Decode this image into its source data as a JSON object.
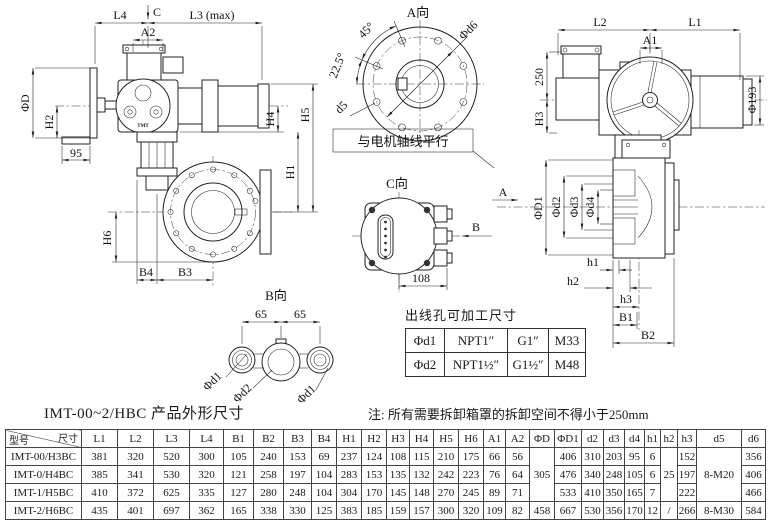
{
  "colors": {
    "ink": "#222222",
    "background": "#ffffff"
  },
  "views": {
    "side_view": {
      "labels": {
        "l4": "L4",
        "c": "C",
        "l3": "L3 (max)",
        "a2": "A2",
        "phi_d": "ΦD",
        "h2": "H2",
        "dim95": "95",
        "h4": "H4",
        "h1": "H1",
        "h5": "H5",
        "h6": "H6",
        "b4": "B4",
        "b3": "B3"
      },
      "logo": "TMT"
    },
    "a_view": {
      "title": "A向",
      "labels": {
        "angle45": "45°",
        "angle225": "22.5°",
        "phi_d6": "Φd6",
        "d5": "d5"
      },
      "note": "与电机轴线平行"
    },
    "front_view": {
      "labels": {
        "l2": "L2",
        "l1": "L1",
        "a1": "A1",
        "dim250": "250",
        "h3": "H3",
        "phi193": "Φ193"
      }
    },
    "section_view": {
      "labels": {
        "a_arrow": "A",
        "phi_d1": "ΦD1",
        "phi_d2": "Φd2",
        "phi_d3": "Φd3",
        "phi_d4": "Φd4",
        "h1": "h1",
        "h2": "h2",
        "h3": "h3",
        "b1": "B1",
        "b2": "B2"
      }
    },
    "c_view": {
      "title": "C向",
      "labels": {
        "b_arrow": "B",
        "dim108": "108"
      }
    },
    "b_view": {
      "title": "B向",
      "labels": {
        "dim65_left": "65",
        "dim65_right": "65",
        "phi_d1_left": "Φd1",
        "phi_d2": "Φd2",
        "phi_d1_right": "Φd1"
      }
    }
  },
  "thread_table": {
    "title": "出线孔可加工尺寸",
    "rows": [
      [
        "Φd1",
        "NPT1″",
        "G1″",
        "M33"
      ],
      [
        "Φd2",
        "NPT1½″",
        "G1½″",
        "M48"
      ]
    ]
  },
  "caption": {
    "title": "IMT-00~2/HBC 产品外形尺寸",
    "note": "注: 所有需要拆卸箱罩的拆卸空间不得小于250mm"
  },
  "dimension_table": {
    "corner": {
      "top_right": "尺寸",
      "bottom_left": "型号"
    },
    "columns": [
      "L1",
      "L2",
      "L3",
      "L4",
      "B1",
      "B2",
      "B3",
      "B4",
      "H1",
      "H2",
      "H3",
      "H4",
      "H5",
      "H6",
      "A1",
      "A2",
      "ΦD",
      "ΦD1",
      "d2",
      "d3",
      "d4",
      "h1",
      "h2",
      "h3",
      "d5",
      "d6"
    ],
    "merged_columns": [
      {
        "index": 16,
        "value": "305"
      },
      {
        "index": 22,
        "value": "25"
      },
      {
        "index": 24,
        "value": "8-M20"
      }
    ],
    "rows": [
      {
        "model": "IMT-00/H3BC",
        "values": [
          "381",
          "320",
          "520",
          "300",
          "105",
          "240",
          "153",
          "69",
          "237",
          "124",
          "108",
          "115",
          "210",
          "175",
          "66",
          "56",
          null,
          "406",
          "310",
          "203",
          "95",
          "6",
          null,
          "152",
          null,
          "356"
        ]
      },
      {
        "model": "IMT-0/H4BC",
        "values": [
          "385",
          "341",
          "530",
          "320",
          "121",
          "258",
          "197",
          "104",
          "283",
          "153",
          "135",
          "132",
          "242",
          "223",
          "76",
          "64",
          null,
          "476",
          "340",
          "248",
          "105",
          "6",
          null,
          "197",
          null,
          "406"
        ]
      },
      {
        "model": "IMT-1/H5BC",
        "values": [
          "410",
          "372",
          "625",
          "335",
          "127",
          "280",
          "248",
          "104",
          "304",
          "170",
          "145",
          "148",
          "270",
          "245",
          "89",
          "71",
          null,
          "533",
          "410",
          "350",
          "165",
          "7",
          null,
          "222",
          null,
          "466"
        ]
      },
      {
        "model": "IMT-2/H6BC",
        "values": [
          "435",
          "401",
          "697",
          "362",
          "165",
          "338",
          "330",
          "125",
          "383",
          "185",
          "159",
          "157",
          "300",
          "320",
          "109",
          "82",
          "458",
          "667",
          "530",
          "356",
          "170",
          "12",
          "/",
          "266",
          "8-M30",
          "584"
        ]
      }
    ]
  }
}
